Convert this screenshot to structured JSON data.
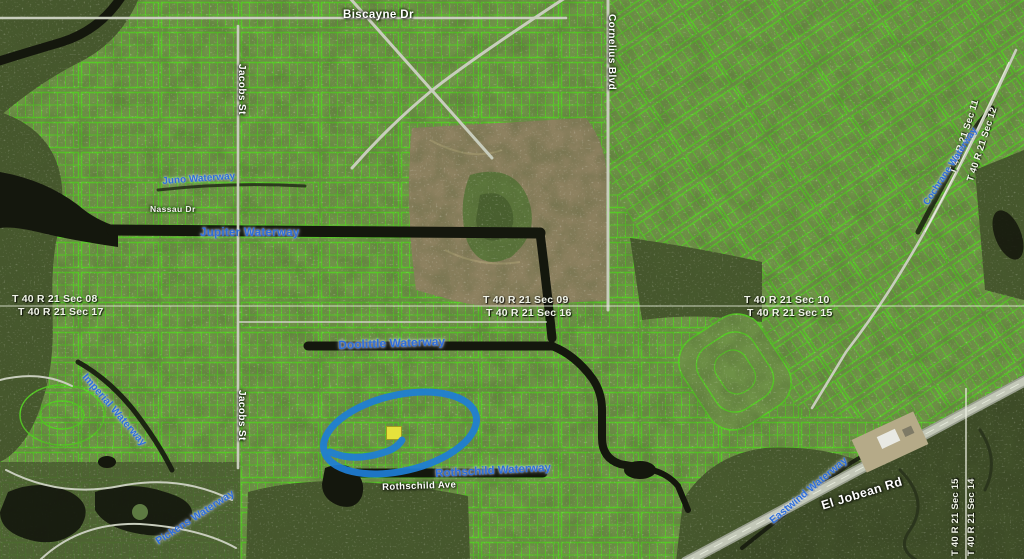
{
  "map": {
    "roads": {
      "biscayne_dr": "Biscayne Dr",
      "cornelius_blvd": "Cornelius Blvd",
      "jacobs_st_north": "Jacobs St",
      "jacobs_st_south": "Jacobs St",
      "nassau_dr": "Nassau Dr",
      "rothschild_ave": "Rothschild Ave",
      "el_jobean_rd": "El Jobean Rd"
    },
    "waterways": {
      "juno": "Juno Waterway",
      "jupiter": "Jupiter Waterway",
      "doolittle": "Doolittle Waterway",
      "imperial": "Imperial Waterway",
      "rothschild": "Rothschild Waterway",
      "pickens": "Pickens Waterway",
      "eastwind": "Eastwind Waterway",
      "cochrane": "Cochrane Waterway"
    },
    "sections": {
      "sec08": "T 40 R 21 Sec 08",
      "sec17": "T 40 R 21 Sec 17",
      "sec09": "T 40 R 21 Sec 09",
      "sec16": "T 40 R 21 Sec 16",
      "sec10": "T 40 R 21 Sec 10",
      "sec15": "T 40 R 21 Sec 15",
      "sec11": "T 40 R 21 Sec 11",
      "sec12": "T 40 R 21 Sec 12",
      "sec15_right": "T 40 R 21 Sec 15",
      "sec14_right": "T 40 R 21 Sec 14"
    },
    "annotation": {
      "shape": "ellipse",
      "color": "#1e7ed6",
      "highlighted_parcel_color": "#e6e23c"
    },
    "colors": {
      "parcel_line": "#55ce24",
      "waterway_label": "#2e6fdb",
      "road_label": "#ffffff",
      "section_label": "#f2f5ea",
      "canal": "#14170d"
    }
  }
}
